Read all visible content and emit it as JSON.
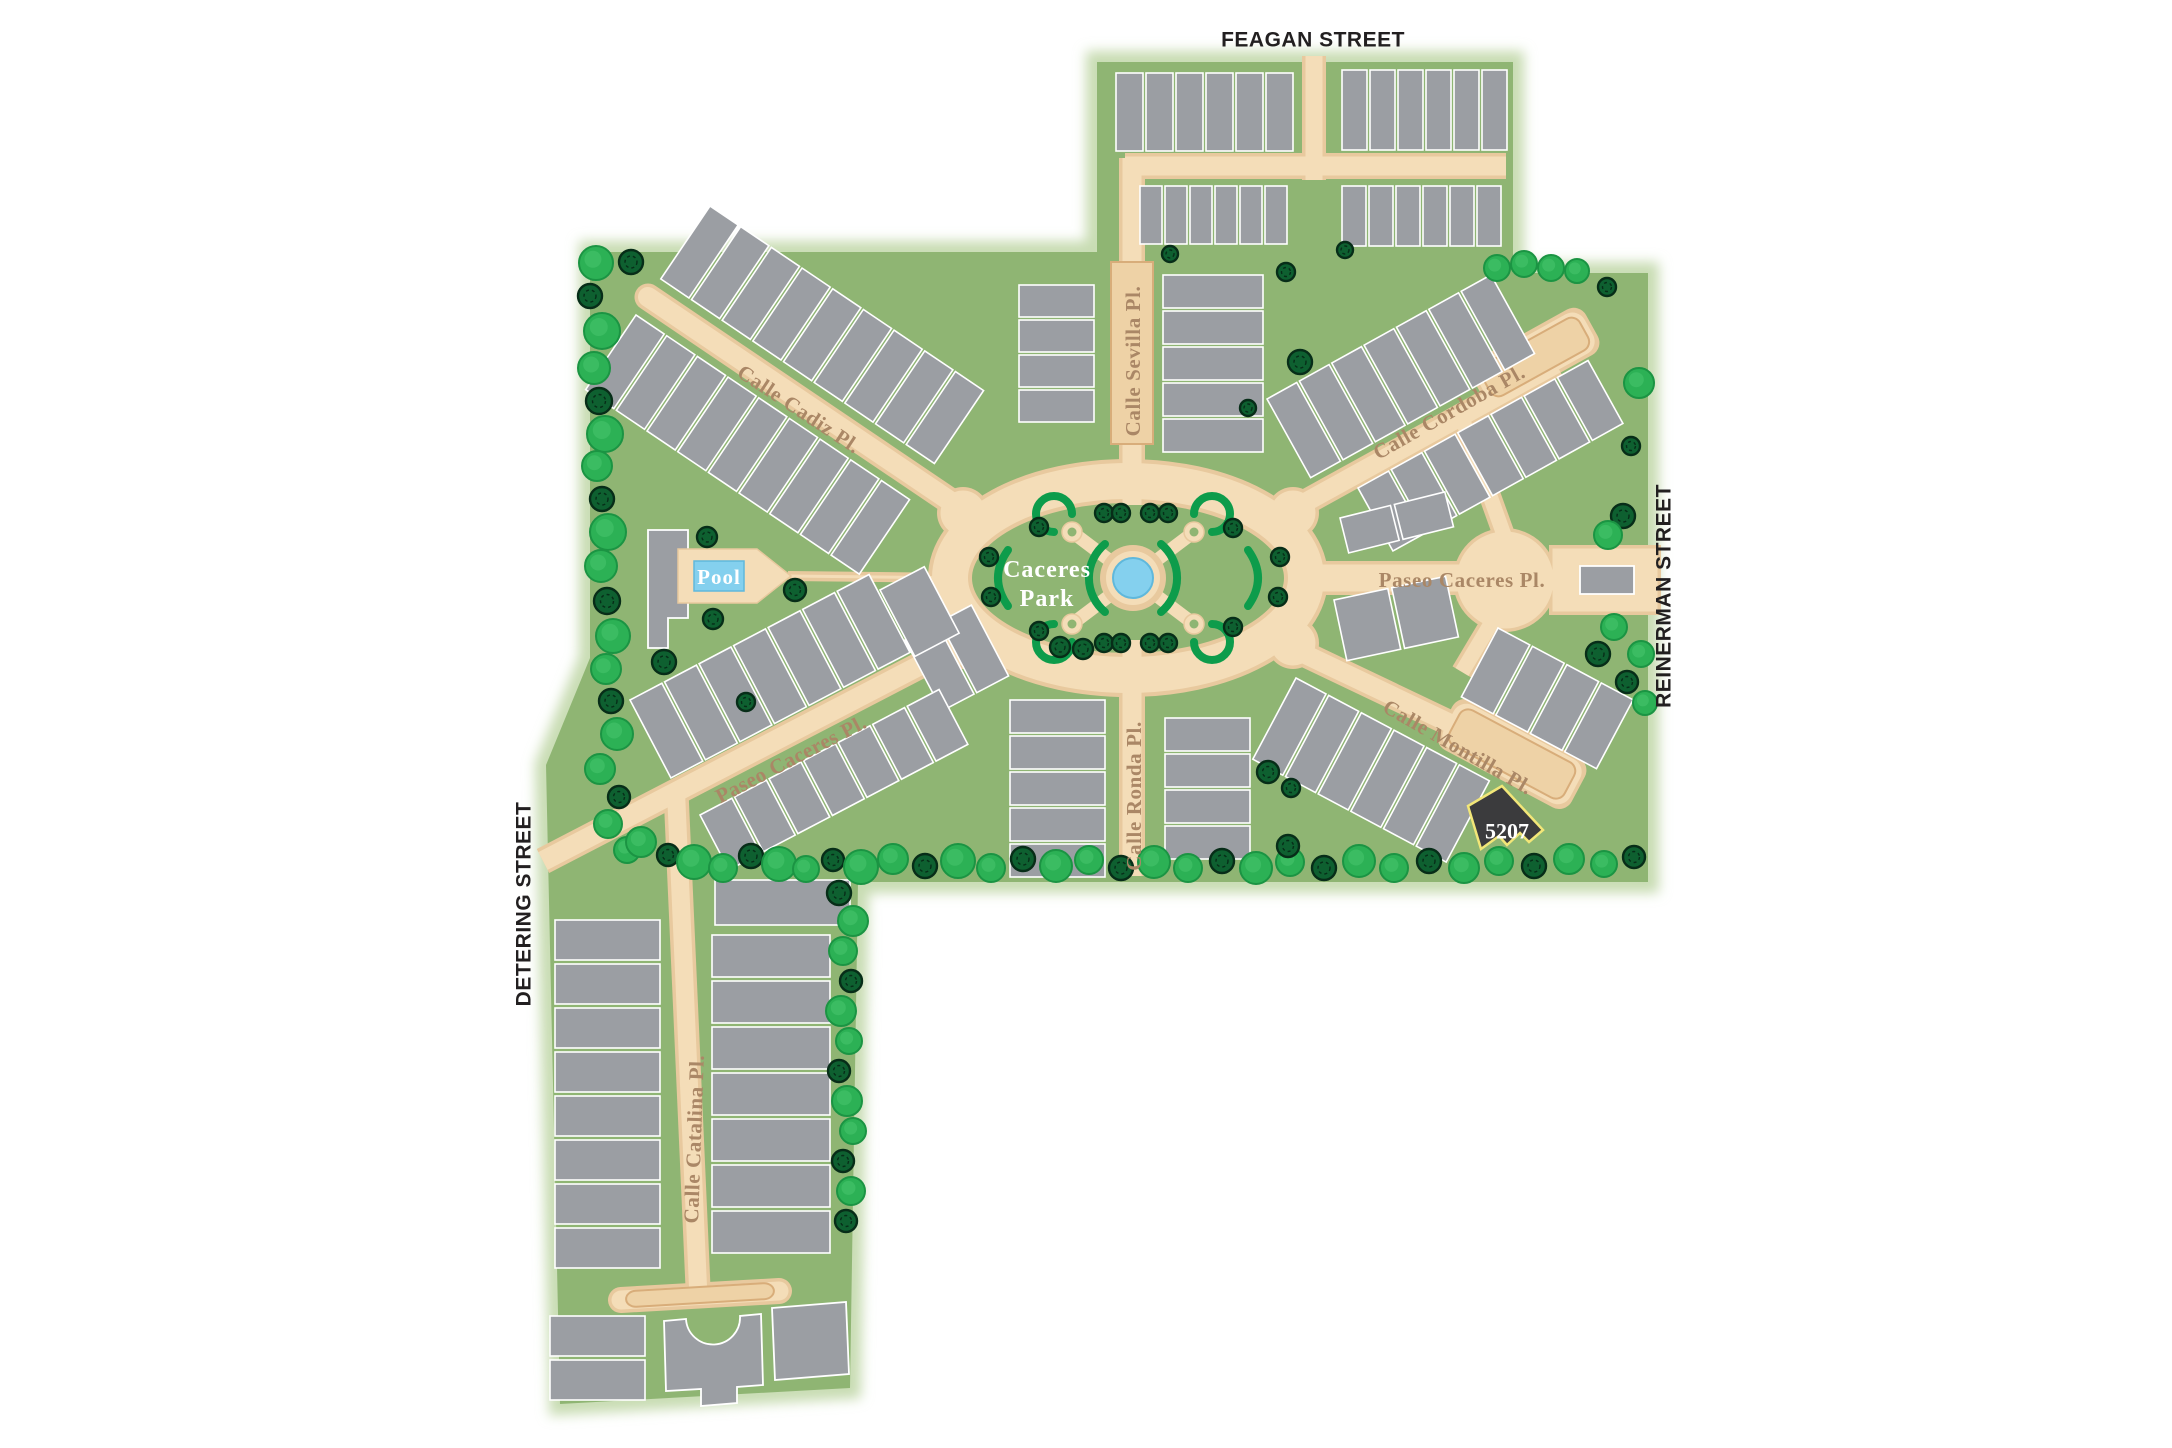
{
  "colors": {
    "site_green": "#8fb573",
    "site_glow": "#c8dcb2",
    "road_edge": "#e8c99e",
    "road_fill": "#f4ddb8",
    "paver_fill": "#eed2a6",
    "paver_edge": "#d8ad7a",
    "building": "#9b9ea3",
    "building_stroke": "#ffffff",
    "tree_bright": "#2cb155",
    "tree_bright_edge": "#1b9443",
    "tree_bright_hi": "#49c46d",
    "tree_dark": "#0e6030",
    "tree_dark_edge": "#072d18",
    "hedge": "#0d9c4b",
    "pool_blue": "#84d0ee",
    "pool_edge": "#5fb8dc",
    "label_brown": "#aa8766",
    "boundary_text": "#221f20",
    "lot_fill": "#3b3b3d",
    "lot_stroke": "#f2e678"
  },
  "labels": {
    "boundary": [
      {
        "label": "FEAGAN STREET"
      },
      {
        "label": "REINERMAN STREET"
      },
      {
        "label": "DETERING STREET"
      }
    ],
    "streets": [
      {
        "label": "Calle Cadiz Pl."
      },
      {
        "label": "Calle Sevilla Pl."
      },
      {
        "label": "Calle Cordoba Pl."
      },
      {
        "label": "Paseo Caceres Pl."
      },
      {
        "label": "Calle Montilla Pl."
      },
      {
        "label": "Paseo Caceres Pl."
      },
      {
        "label": "Calle Ronda Pl."
      },
      {
        "label": "Calle Catalina Pl."
      }
    ]
  },
  "park_label": {
    "line1": "Caceres",
    "line2": "Park"
  },
  "pool": {
    "label": "Pool"
  },
  "featured_lot": {
    "label": "5207"
  },
  "site": {
    "outline": [
      [
        590,
        252
      ],
      [
        1097,
        252
      ],
      [
        1097,
        62
      ],
      [
        1513,
        62
      ],
      [
        1513,
        273
      ],
      [
        1648,
        273
      ],
      [
        1648,
        882
      ],
      [
        858,
        882
      ],
      [
        850,
        1388
      ],
      [
        560,
        1404
      ],
      [
        546,
        765
      ],
      [
        590,
        658
      ]
    ]
  },
  "roads": [
    {
      "kind": "line",
      "x1": 1314,
      "y1": 56,
      "x2": 1314,
      "y2": 180,
      "w": 24
    },
    {
      "kind": "line",
      "x1": 1125,
      "y1": 166,
      "x2": 1506,
      "y2": 166,
      "w": 26
    },
    {
      "kind": "line",
      "x1": 1132,
      "y1": 158,
      "x2": 1132,
      "y2": 505,
      "w": 26
    },
    {
      "kind": "line",
      "x1": 648,
      "y1": 297,
      "x2": 978,
      "y2": 520,
      "w": 27,
      "cap": "round"
    },
    {
      "kind": "line",
      "x1": 963,
      "y1": 643,
      "x2": 543,
      "y2": 861,
      "w": 27
    },
    {
      "kind": "line",
      "x1": 676,
      "y1": 792,
      "x2": 698,
      "y2": 1287,
      "w": 25
    },
    {
      "kind": "line",
      "x1": 621,
      "y1": 1300,
      "x2": 779,
      "y2": 1291,
      "w": 26,
      "cap": "round"
    },
    {
      "kind": "line",
      "x1": 1132,
      "y1": 640,
      "x2": 1132,
      "y2": 876,
      "w": 26
    },
    {
      "kind": "line",
      "x1": 1288,
      "y1": 512,
      "x2": 1556,
      "y2": 364,
      "w": 26
    },
    {
      "kind": "line",
      "x1": 1462,
      "y1": 418,
      "x2": 1504,
      "y2": 535,
      "w": 22
    },
    {
      "kind": "line",
      "x1": 1300,
      "y1": 578,
      "x2": 1505,
      "y2": 578,
      "w": 34
    },
    {
      "kind": "line",
      "x1": 1505,
      "y1": 600,
      "x2": 1462,
      "y2": 672,
      "w": 22
    },
    {
      "kind": "line",
      "x1": 1296,
      "y1": 650,
      "x2": 1548,
      "y2": 770,
      "w": 26
    },
    {
      "kind": "ellipse",
      "cx": 1128,
      "cy": 578,
      "rx": 178,
      "ry": 97,
      "w": 40
    },
    {
      "kind": "circle",
      "cx": 963,
      "cy": 513,
      "r": 26
    },
    {
      "kind": "circle",
      "cx": 963,
      "cy": 643,
      "r": 26
    },
    {
      "kind": "circle",
      "cx": 1293,
      "cy": 513,
      "r": 26
    },
    {
      "kind": "circle",
      "cx": 1293,
      "cy": 643,
      "r": 26
    },
    {
      "kind": "circle",
      "cx": 1505,
      "cy": 580,
      "r": 52
    },
    {
      "kind": "rect",
      "x": 1549,
      "y": 545,
      "wd": 112,
      "ht": 70
    },
    {
      "kind": "line",
      "x1": 788,
      "y1": 576,
      "x2": 965,
      "y2": 578,
      "w": 10
    },
    {
      "kind": "bar",
      "cx": 1535,
      "cy": 357,
      "a": -29,
      "len": 130,
      "wd": 52
    },
    {
      "kind": "bar",
      "cx": 1512,
      "cy": 754,
      "a": 28,
      "len": 150,
      "wd": 56
    }
  ],
  "pavers": [
    {
      "x": 1111,
      "y": 262,
      "wd": 42,
      "ht": 182
    },
    {
      "cx": 1535,
      "cy": 357,
      "a": -29,
      "len": 112,
      "wd": 36
    },
    {
      "cx": 1512,
      "cy": 754,
      "a": 28,
      "len": 130,
      "wd": 40
    },
    {
      "cx": 700,
      "cy": 1295,
      "a": -3.4,
      "len": 148,
      "wd": 16
    }
  ],
  "park": {
    "pond": {
      "cx": 1133,
      "cy": 578,
      "ring_r": 33,
      "water_r": 20
    },
    "cross_ends": [
      [
        1072,
        532
      ],
      [
        1194,
        532
      ],
      [
        1072,
        624
      ],
      [
        1194,
        624
      ]
    ],
    "hedge_paths": [
      "M1105,612 A44,44 0 0 1 1105,544",
      "M1161,544 A44,44 0 0 1 1161,612",
      "M1008,550 Q988,578 1008,606",
      "M1248,550 Q1268,578 1248,606",
      "M1054,532 A18,18 0 1 1 1072,514",
      "M1212,532 A18,18 0 1 0 1194,514",
      "M1054,624 A18,18 0 1 0 1072,642",
      "M1212,624 A18,18 0 1 1 1194,642"
    ]
  },
  "building_rows": [
    {
      "x": 1116,
      "y": 73,
      "a": 0,
      "n": 6,
      "uw": 27,
      "g": 3,
      "d": 78
    },
    {
      "x": 1342,
      "y": 70,
      "a": 0,
      "n": 6,
      "uw": 25,
      "g": 3,
      "d": 80
    },
    {
      "x": 1140,
      "y": 186,
      "a": 0,
      "n": 6,
      "uw": 22,
      "g": 3,
      "d": 58
    },
    {
      "x": 1342,
      "y": 186,
      "a": 0,
      "n": 6,
      "uw": 24,
      "g": 3,
      "d": 60
    },
    {
      "x": 710,
      "y": 206,
      "a": 34,
      "n": 9,
      "uw": 34,
      "g": 3,
      "d": 88
    },
    {
      "x": 636,
      "y": 315,
      "a": 34,
      "n": 9,
      "uw": 34,
      "g": 3,
      "d": 90
    },
    {
      "x": 1263,
      "y": 275,
      "a": 90,
      "n": 5,
      "uw": 33,
      "g": 3,
      "d": 100
    },
    {
      "x": 1094,
      "y": 285,
      "a": 90,
      "n": 4,
      "uw": 32,
      "g": 3,
      "d": 75
    },
    {
      "x": 1267,
      "y": 399,
      "a": -29,
      "n": 7,
      "uw": 34,
      "g": 3,
      "d": 90
    },
    {
      "x": 1358,
      "y": 488,
      "a": -29,
      "n": 7,
      "uw": 35,
      "g": 3,
      "d": 72
    },
    {
      "x": 1340,
      "y": 518,
      "a": -14,
      "n": 2,
      "uw": 52,
      "g": 4,
      "d": 36
    },
    {
      "x": 1334,
      "y": 600,
      "a": -12,
      "n": 2,
      "uw": 55,
      "g": 4,
      "d": 62
    },
    {
      "x": 1498,
      "y": 628,
      "a": 28,
      "n": 4,
      "uw": 36,
      "g": 3,
      "d": 78
    },
    {
      "x": 1296,
      "y": 678,
      "a": 28,
      "n": 6,
      "uw": 34,
      "g": 3,
      "d": 92
    },
    {
      "x": 1105,
      "y": 700,
      "a": 90,
      "n": 5,
      "uw": 33,
      "g": 3,
      "d": 95
    },
    {
      "x": 1250,
      "y": 718,
      "a": 90,
      "n": 4,
      "uw": 33,
      "g": 3,
      "d": 85
    },
    {
      "x": 630,
      "y": 700,
      "a": -27.7,
      "n": 7,
      "uw": 36,
      "g": 3,
      "d": 88
    },
    {
      "x": 905,
      "y": 640,
      "a": -27.7,
      "n": 2,
      "uw": 36,
      "g": 3,
      "d": 80
    },
    {
      "x": 700,
      "y": 815,
      "a": -27.7,
      "n": 7,
      "uw": 36,
      "g": 3,
      "d": 62
    },
    {
      "x": 880,
      "y": 590,
      "a": -27.7,
      "n": 1,
      "uw": 50,
      "g": 0,
      "d": 75
    },
    {
      "x": 660,
      "y": 920,
      "a": 90,
      "n": 8,
      "uw": 40,
      "g": 4,
      "d": 105
    },
    {
      "x": 645,
      "y": 1316,
      "a": 90,
      "n": 2,
      "uw": 40,
      "g": 4,
      "d": 95
    },
    {
      "x": 830,
      "y": 935,
      "a": 90,
      "n": 7,
      "uw": 42,
      "g": 4,
      "d": 118
    },
    {
      "x": 850,
      "y": 880,
      "a": 90,
      "n": 1,
      "uw": 45,
      "g": 0,
      "d": 135
    }
  ],
  "shapes": [
    {
      "name": "clubhouse-building",
      "cls": "building",
      "d": "M648,530 L688,530 L688,555 L700,555 L700,592 L688,592 L688,618 L668,618 L668,648 L648,648 Z"
    },
    {
      "name": "pool-deck",
      "cls": "deck",
      "d": "M678,549 L757,549 L791,576 L757,603 L678,603 Z"
    },
    {
      "name": "pool-water",
      "cls": "pool",
      "d": "M694,561 L744,561 L744,591 L694,591 Z"
    },
    {
      "name": "gatehouse",
      "cls": "building",
      "d": "M1580,566 L1634,566 L1634,594 L1580,594 Z"
    },
    {
      "name": "arch-building",
      "cls": "building",
      "d": "M664,1321 L686,1319 A27,27 0 0 0 740,1316 L761,1314 L763,1385 L737,1387 L737,1403 L701,1406 L701,1389 L666,1391 Z"
    },
    {
      "name": "corner-building",
      "cls": "building",
      "d": "M772,1308 L846,1302 L849,1374 L775,1380 Z"
    },
    {
      "name": "featured-lot-5207",
      "cls": "lot",
      "d": "M1468,806 L1502,786 L1543,830 L1529,842 L1520,833 L1507,845 L1499,836 L1481,849 Z"
    }
  ],
  "trees": [
    [
      596,
      263,
      17,
      "b"
    ],
    [
      590,
      296,
      12,
      "d"
    ],
    [
      602,
      331,
      18,
      "b"
    ],
    [
      594,
      368,
      16,
      "b"
    ],
    [
      599,
      401,
      13,
      "d"
    ],
    [
      605,
      434,
      18,
      "b"
    ],
    [
      597,
      466,
      15,
      "b"
    ],
    [
      602,
      499,
      12,
      "d"
    ],
    [
      608,
      532,
      18,
      "b"
    ],
    [
      601,
      566,
      16,
      "b"
    ],
    [
      607,
      601,
      13,
      "d"
    ],
    [
      613,
      636,
      17,
      "b"
    ],
    [
      606,
      669,
      15,
      "b"
    ],
    [
      611,
      701,
      12,
      "d"
    ],
    [
      617,
      734,
      16,
      "b"
    ],
    [
      631,
      262,
      12,
      "d"
    ],
    [
      600,
      769,
      15,
      "b"
    ],
    [
      619,
      797,
      11,
      "d"
    ],
    [
      608,
      824,
      14,
      "b"
    ],
    [
      627,
      850,
      13,
      "b"
    ],
    [
      641,
      842,
      15,
      "b"
    ],
    [
      668,
      855,
      11,
      "d"
    ],
    [
      694,
      862,
      17,
      "b"
    ],
    [
      723,
      868,
      14,
      "b"
    ],
    [
      751,
      856,
      12,
      "d"
    ],
    [
      779,
      864,
      17,
      "b"
    ],
    [
      806,
      869,
      13,
      "b"
    ],
    [
      833,
      860,
      11,
      "d"
    ],
    [
      861,
      867,
      17,
      "b"
    ],
    [
      893,
      859,
      15,
      "b"
    ],
    [
      925,
      866,
      12,
      "d"
    ],
    [
      958,
      861,
      17,
      "b"
    ],
    [
      991,
      868,
      14,
      "b"
    ],
    [
      1023,
      859,
      12,
      "d"
    ],
    [
      1056,
      866,
      16,
      "b"
    ],
    [
      1089,
      860,
      14,
      "b"
    ],
    [
      1121,
      868,
      12,
      "d"
    ],
    [
      1154,
      862,
      16,
      "b"
    ],
    [
      1188,
      868,
      14,
      "b"
    ],
    [
      1222,
      861,
      12,
      "d"
    ],
    [
      1256,
      868,
      16,
      "b"
    ],
    [
      1290,
      862,
      14,
      "b"
    ],
    [
      1324,
      868,
      12,
      "d"
    ],
    [
      1359,
      861,
      16,
      "b"
    ],
    [
      1394,
      868,
      14,
      "b"
    ],
    [
      1429,
      861,
      12,
      "d"
    ],
    [
      1464,
      868,
      15,
      "b"
    ],
    [
      1499,
      861,
      14,
      "b"
    ],
    [
      1534,
      866,
      12,
      "d"
    ],
    [
      1569,
      859,
      15,
      "b"
    ],
    [
      1604,
      864,
      13,
      "b"
    ],
    [
      1634,
      857,
      11,
      "d"
    ],
    [
      1639,
      383,
      15,
      "b"
    ],
    [
      1631,
      446,
      9,
      "d"
    ],
    [
      1623,
      516,
      12,
      "d"
    ],
    [
      1608,
      535,
      14,
      "b"
    ],
    [
      1614,
      627,
      13,
      "b"
    ],
    [
      1641,
      654,
      13,
      "b"
    ],
    [
      1627,
      682,
      11,
      "d"
    ],
    [
      1645,
      703,
      12,
      "b"
    ],
    [
      1598,
      654,
      12,
      "d"
    ],
    [
      1497,
      268,
      13,
      "b"
    ],
    [
      1524,
      264,
      13,
      "b"
    ],
    [
      1551,
      268,
      13,
      "b"
    ],
    [
      1577,
      271,
      12,
      "b"
    ],
    [
      1607,
      287,
      9,
      "d"
    ],
    [
      1170,
      254,
      8,
      "d"
    ],
    [
      1345,
      250,
      8,
      "d"
    ],
    [
      1286,
      272,
      9,
      "d"
    ],
    [
      1300,
      362,
      12,
      "d"
    ],
    [
      1248,
      408,
      8,
      "d"
    ],
    [
      989,
      557,
      9,
      "d"
    ],
    [
      991,
      597,
      9,
      "d"
    ],
    [
      1039,
      527,
      9,
      "d"
    ],
    [
      1104,
      513,
      9,
      "d"
    ],
    [
      1121,
      513,
      9,
      "d"
    ],
    [
      1150,
      513,
      9,
      "d"
    ],
    [
      1168,
      513,
      9,
      "d"
    ],
    [
      1233,
      528,
      9,
      "d"
    ],
    [
      1280,
      557,
      9,
      "d"
    ],
    [
      1278,
      597,
      9,
      "d"
    ],
    [
      1039,
      631,
      9,
      "d"
    ],
    [
      1104,
      643,
      9,
      "d"
    ],
    [
      1121,
      643,
      9,
      "d"
    ],
    [
      1150,
      643,
      9,
      "d"
    ],
    [
      1168,
      643,
      9,
      "d"
    ],
    [
      1233,
      627,
      9,
      "d"
    ],
    [
      707,
      537,
      10,
      "d"
    ],
    [
      795,
      590,
      11,
      "d"
    ],
    [
      713,
      619,
      10,
      "d"
    ],
    [
      664,
      662,
      12,
      "d"
    ],
    [
      746,
      702,
      9,
      "d"
    ],
    [
      1060,
      647,
      10,
      "d"
    ],
    [
      1083,
      649,
      10,
      "d"
    ],
    [
      1268,
      772,
      11,
      "d"
    ],
    [
      1291,
      788,
      9,
      "d"
    ],
    [
      1288,
      846,
      11,
      "d"
    ],
    [
      839,
      893,
      12,
      "d"
    ],
    [
      853,
      921,
      15,
      "b"
    ],
    [
      843,
      951,
      14,
      "b"
    ],
    [
      851,
      981,
      11,
      "d"
    ],
    [
      841,
      1011,
      15,
      "b"
    ],
    [
      849,
      1041,
      13,
      "b"
    ],
    [
      839,
      1071,
      11,
      "d"
    ],
    [
      847,
      1101,
      15,
      "b"
    ],
    [
      853,
      1131,
      13,
      "b"
    ],
    [
      843,
      1161,
      11,
      "d"
    ],
    [
      851,
      1191,
      14,
      "b"
    ],
    [
      846,
      1221,
      11,
      "d"
    ]
  ]
}
